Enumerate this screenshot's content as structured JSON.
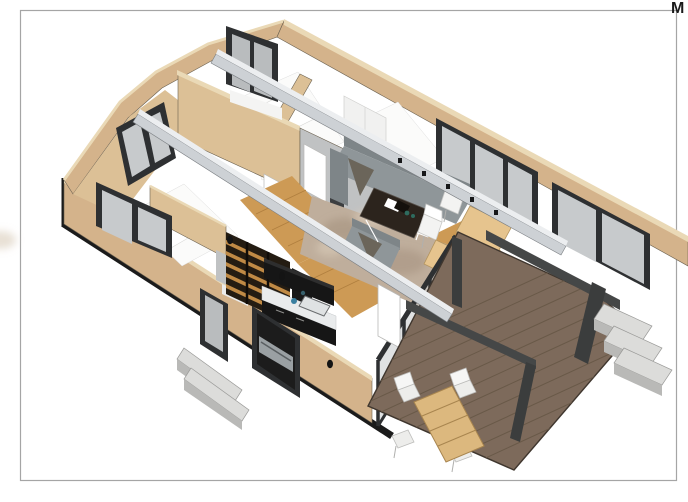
{
  "sheet": {
    "corner_label": "M",
    "border_color": "#a5a5a5",
    "background": "#ffffff"
  },
  "scene": {
    "type": "3d-architectural-cutaway-floor-plan",
    "rooms": [
      "bedroom",
      "bedroom",
      "bedroom",
      "bathroom",
      "walk-in-closet",
      "kitchen",
      "living-room",
      "dining-area",
      "deck"
    ],
    "furniture_counts": {
      "sofas": 2,
      "coffee_tables": 1,
      "indoor_chairs": 2,
      "outdoor_chairs": 4,
      "tables": 3,
      "beds": 2,
      "sinks": 1,
      "step-flights": 2
    }
  },
  "colors": {
    "wall": "#d4b38b",
    "wallTop": "#ead9b6",
    "wallInner": "#dcc096",
    "grayWall": "#c0c2c3",
    "frameDark": "#2e3032",
    "glass": "#c7cacc",
    "glassDim": "#b9bcbe",
    "floorWhite": "#fbfbfa",
    "wood": "#cd9a55",
    "woodDark": "#b07f3f",
    "rug": "#bfae9c",
    "rugDark": "#a3907c",
    "rugLight": "#d8cbb9",
    "sofa": "#8f9699",
    "sofaDark": "#7e8588",
    "throwBlanket": "#6b655a",
    "tableDark": "#2c241d",
    "chairWhite": "#f3f3f2",
    "counter": "#e9ebec",
    "cabinet": "#161616",
    "shelfWood": "#c08a45",
    "shelfBg": "#241c12",
    "beam": "#cdd1d5",
    "beamTop": "#eceef0",
    "deck": "#7d6a5b",
    "deckLine": "#695948",
    "pergola": "#454747",
    "pergolaPost": "#3b3d3d",
    "steps": "#dcdcda",
    "stepsSide": "#b9b9b7",
    "plinth": "#1b1b1b",
    "teal": "#2e6b5e",
    "blue": "#3a7fa0",
    "tanTable": "#e6c48e",
    "deckTable": "#dcb87e",
    "white": "#ffffff"
  }
}
